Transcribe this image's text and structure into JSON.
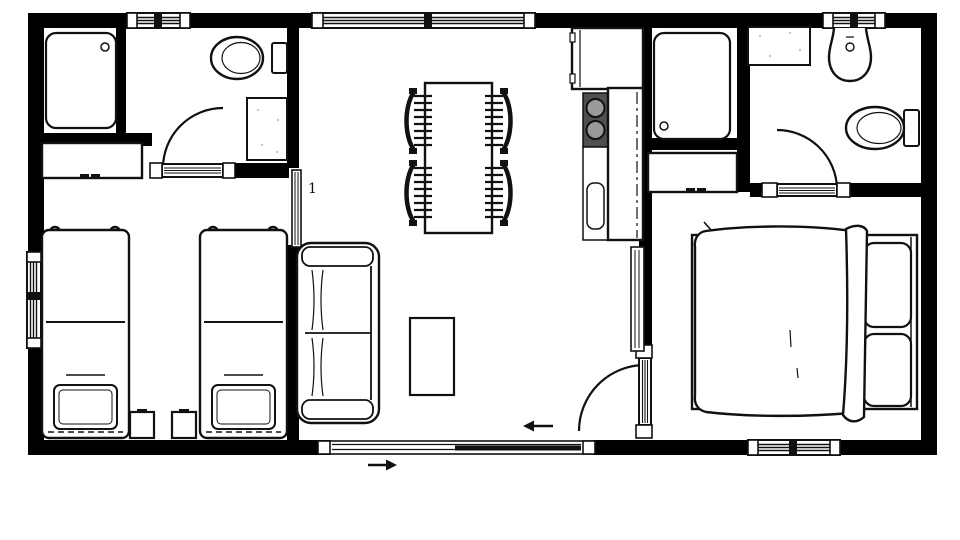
{
  "plan": {
    "room_label": "1",
    "colors": {
      "wall": "#000000",
      "background": "#ffffff",
      "line": "#111111",
      "cooktop": "#4f4f4f",
      "burner": "#9a9a9a"
    },
    "fixtures": {
      "shower_left": "shower-tray",
      "toilet_left": "toilet",
      "vanity_left": "vanity-sink",
      "wardrobe_left": "wardrobe",
      "twin_bed_1": "single-bed",
      "twin_bed_2": "single-bed",
      "nightstands": "bedside-tables",
      "sofa": "two-seat-sofa",
      "coffee_table": "coffee-table",
      "dining_table": "dining-table",
      "dining_chairs": "four-chairs",
      "fridge": "refrigerator",
      "cooktop": "two-burner-cooktop",
      "sink": "kitchen-sink",
      "counter": "kitchen-counter",
      "shower_right": "shower-tray",
      "wardrobe_right": "wardrobe",
      "vanity_right": "vanity-counter",
      "basin_right": "wash-basin",
      "toilet_right": "toilet",
      "double_bed": "double-bed",
      "entry_arrow_in": "arrow-left",
      "entry_arrow_out": "arrow-right"
    }
  }
}
